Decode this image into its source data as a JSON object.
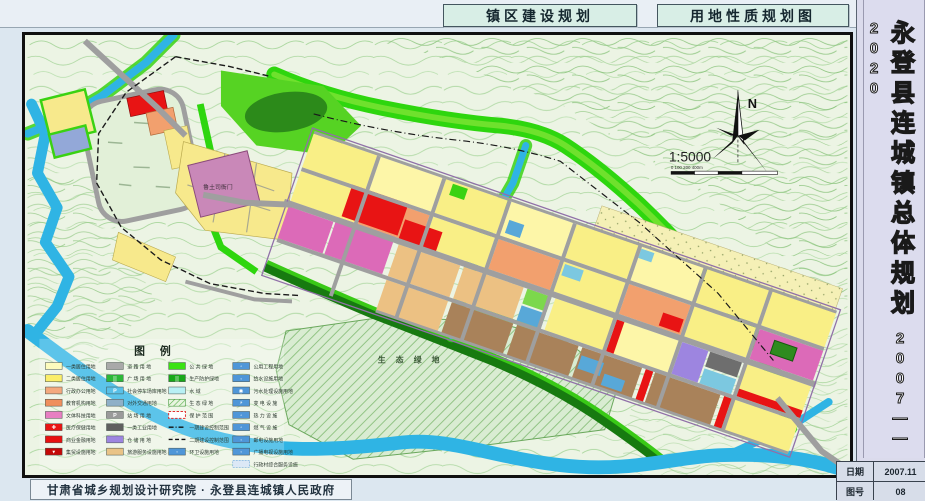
{
  "header": {
    "title_left": "镇区建设规划",
    "title_right": "用地性质规划图"
  },
  "sidebar": {
    "title": "永登县连城镇总体规划",
    "years": "2007——2020",
    "info_table": {
      "rows": [
        {
          "label": "日期",
          "value": "2007.11"
        },
        {
          "label": "图号",
          "value": "08"
        }
      ]
    }
  },
  "footer": {
    "credit": "甘肃省城乡规划设计研究院 · 永登县连城镇人民政府"
  },
  "map": {
    "labels": {
      "north": "N",
      "scale": "1:5000",
      "scale_ticks": "0   100    200                400m",
      "eco_area": "生 态 绿 地",
      "heritage_site": "鲁土司衙门"
    },
    "colors": {
      "river": "#2fb4e4",
      "green_belt": "#2ed60e",
      "residential1": "#fdfbbd",
      "residential2": "#fbee6a",
      "commercial": "#e81010",
      "road": "#9f9f9f"
    },
    "legend": {
      "title": "图    例",
      "columns": [
        {
          "items": [
            {
              "type": "swatch",
              "color": "#fdfbbd",
              "label": "一类居住用地"
            },
            {
              "type": "swatch",
              "color": "#fbee6a",
              "label": "二类居住用地"
            },
            {
              "type": "swatch",
              "color": "#f4a97e",
              "label": "行政办公用地"
            },
            {
              "type": "swatch",
              "color": "#ef8f5e",
              "label": "教育机构用地"
            },
            {
              "type": "swatch",
              "color": "#e77fc2",
              "label": "文体科技用地"
            },
            {
              "type": "swatch",
              "color": "#e81414",
              "label": "医疗保健用地",
              "icon": "✚"
            },
            {
              "type": "swatch",
              "color": "#e81010",
              "label": "商业金融用地"
            },
            {
              "type": "swatch",
              "color": "#c40808",
              "label": "集贸设施用地",
              "icon": "▾"
            }
          ]
        },
        {
          "items": [
            {
              "type": "swatch",
              "color": "#a9a9a9",
              "label": "道 路 用 地"
            },
            {
              "type": "swatch",
              "color": "#2cb838",
              "label": "广 场 用 地",
              "icon": "▒"
            },
            {
              "type": "swatch",
              "color": "#58c0e8",
              "label": "社会停车场库用地",
              "icon": "P"
            },
            {
              "type": "swatch",
              "color": "#8fb0c8",
              "label": "对外交通用地"
            },
            {
              "type": "swatch",
              "color": "#9a9a9a",
              "label": "站 场 用 地",
              "icon": "P"
            },
            {
              "type": "swatch",
              "color": "#5f5f5f",
              "label": "一类工业用地"
            },
            {
              "type": "swatch",
              "color": "#9d85e0",
              "label": "仓 储 用 地"
            },
            {
              "type": "swatch",
              "color": "#e9c387",
              "label": "旅游服务设施用地"
            }
          ]
        },
        {
          "items": [
            {
              "type": "swatch",
              "color": "#3ae212",
              "label": "公 共 绿 地"
            },
            {
              "type": "swatch",
              "color": "#18a818",
              "label": "生产防护绿地",
              "icon": "▒"
            },
            {
              "type": "swatch",
              "color": "#b8f0f4",
              "label": "水        域"
            },
            {
              "type": "hatch-green",
              "color": "#d9ecd2",
              "label": "生 态 绿 地"
            },
            {
              "type": "dash-red-box",
              "color": "#ffffff",
              "label": "保 护 范 围"
            },
            {
              "type": "line-dashdot",
              "color": "#111111",
              "label": "一期建设控制范围"
            },
            {
              "type": "line-dash",
              "color": "#111111",
              "label": "二期建设控制范围"
            },
            {
              "type": "swatch",
              "color": "#4f96d8",
              "label": "环卫设施用地",
              "icon": "◦"
            }
          ]
        },
        {
          "items": [
            {
              "type": "swatch",
              "color": "#4f96d8",
              "label": "公用工程用地",
              "icon": "◦"
            },
            {
              "type": "swatch",
              "color": "#4f96d8",
              "label": "给水设施用地",
              "icon": "◦"
            },
            {
              "type": "swatch",
              "color": "#4f96d8",
              "label": "污水处理设施用地",
              "icon": "◉"
            },
            {
              "type": "swatch",
              "color": "#4f96d8",
              "label": "变 电 设 施",
              "icon": "⚡"
            },
            {
              "type": "swatch",
              "color": "#4f96d8",
              "label": "热 力 设 施",
              "icon": "◦"
            },
            {
              "type": "swatch",
              "color": "#4f96d8",
              "label": "燃 气 设 施",
              "icon": "◦"
            },
            {
              "type": "swatch",
              "color": "#4f96d8",
              "label": "邮电设施用地",
              "icon": "◦"
            },
            {
              "type": "swatch",
              "color": "#4f96d8",
              "label": "广播电视设施用地",
              "icon": "◦"
            },
            {
              "type": "hatch-blue",
              "color": "#dce8f6",
              "label": "行政村综合服务设施"
            }
          ]
        }
      ]
    }
  }
}
